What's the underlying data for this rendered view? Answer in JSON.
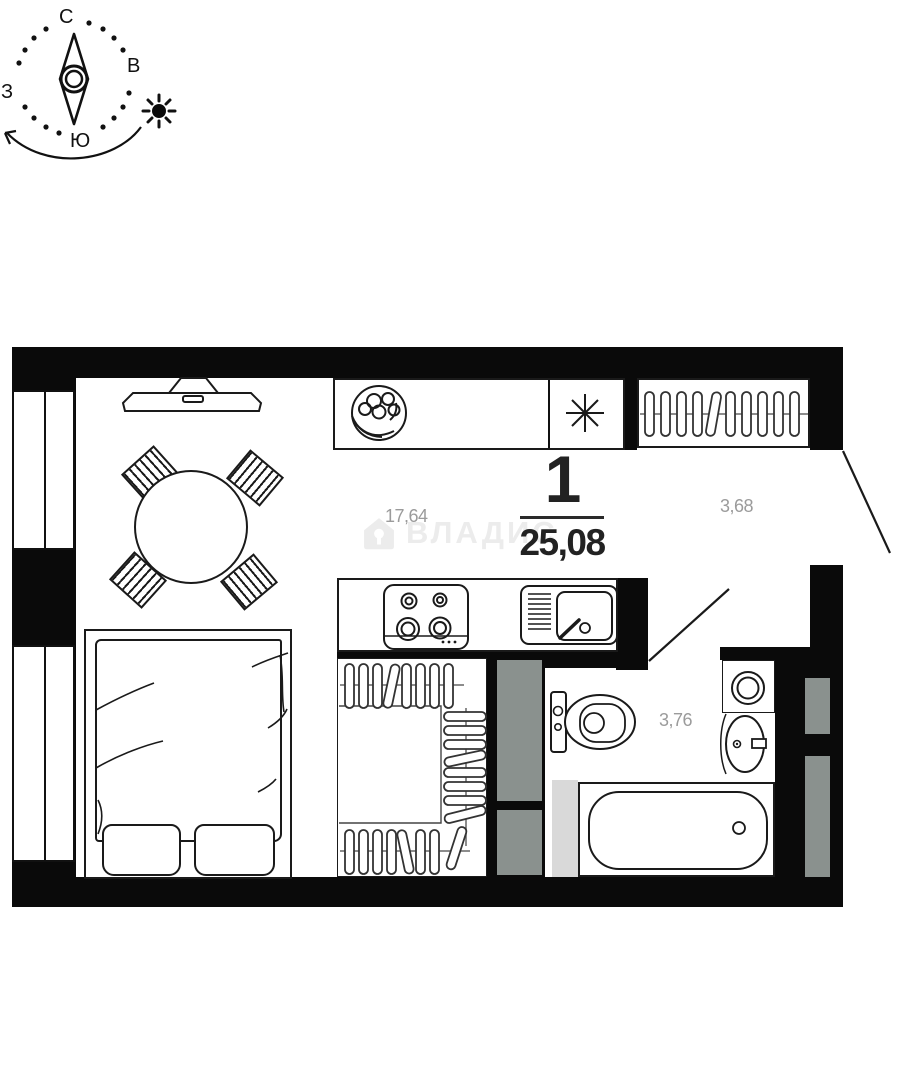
{
  "compass": {
    "north": "С",
    "east": "В",
    "south": "Ю",
    "west": "З"
  },
  "apartment": {
    "rooms_count": "1",
    "total_area_m2": "25,08"
  },
  "room_areas": {
    "living_kitchen_m2": "17,64",
    "hallway_m2": "3,68",
    "bathroom_m2": "3,76"
  },
  "watermark": {
    "brand": "ВЛАДИС"
  },
  "icons": {
    "compass_sun": "sun-icon",
    "compass_needle": "compass-needle-icon",
    "kitchen_light": "asterisk-icon",
    "logo": "house-icon"
  },
  "colors": {
    "walls": "#0a0a0a",
    "lines": "#1a1a1a",
    "area_labels": "#9b9b9b",
    "vent_shaft": "#8a918e",
    "light_panel": "#d9d9d9",
    "watermark": "#ececec"
  }
}
